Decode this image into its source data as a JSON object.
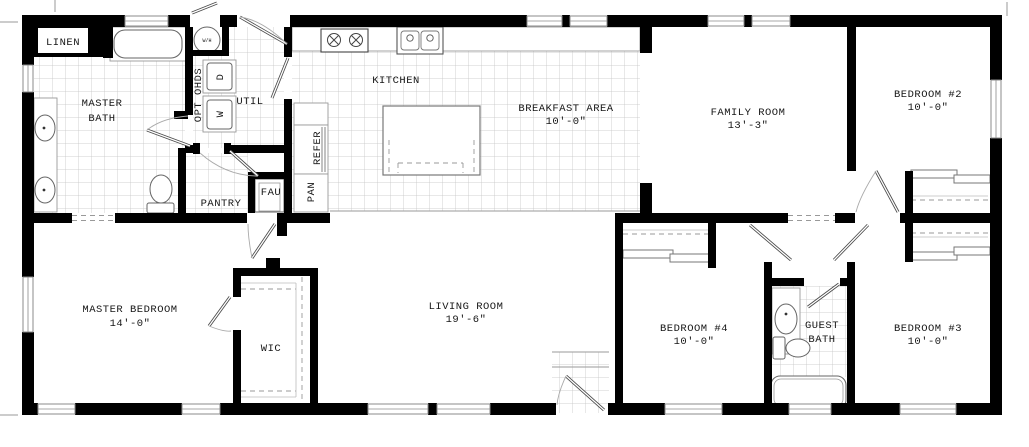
{
  "title": "Floor plan",
  "colors": {
    "wall": "#000000",
    "tile_line": "#c4c4c4",
    "fixture_line": "#666666",
    "label_text": "#161616",
    "background": "#ffffff"
  },
  "rooms": {
    "linen": {
      "label": "LINEN"
    },
    "master_bath": {
      "label_line1": "MASTER",
      "label_line2": "BATH"
    },
    "util": {
      "label": "UTIL"
    },
    "opt_ohds": {
      "label": "OPT OHDS"
    },
    "dryer": {
      "label": "D"
    },
    "washer": {
      "label": "W"
    },
    "water_heater": {
      "label": "W/H"
    },
    "kitchen": {
      "label": "KITCHEN"
    },
    "refer": {
      "label": "REFER"
    },
    "pan": {
      "label": "PAN"
    },
    "pantry": {
      "label": "PANTRY"
    },
    "fau": {
      "label": "FAU"
    },
    "breakfast_area": {
      "label": "BREAKFAST AREA",
      "dimension": "10'-0\""
    },
    "family_room": {
      "label": "FAMILY ROOM",
      "dimension": "13'-3\""
    },
    "bedroom_2": {
      "label": "BEDROOM #2",
      "dimension": "10'-0\""
    },
    "master_bedroom": {
      "label": "MASTER BEDROOM",
      "dimension": "14'-0\""
    },
    "wic": {
      "label": "WIC"
    },
    "living_room": {
      "label": "LIVING ROOM",
      "dimension": "19'-6\""
    },
    "bedroom_4": {
      "label": "BEDROOM #4",
      "dimension": "10'-0\""
    },
    "guest_bath": {
      "label_line1": "GUEST",
      "label_line2": "BATH"
    },
    "bedroom_3": {
      "label": "BEDROOM #3",
      "dimension": "10'-0\""
    }
  }
}
